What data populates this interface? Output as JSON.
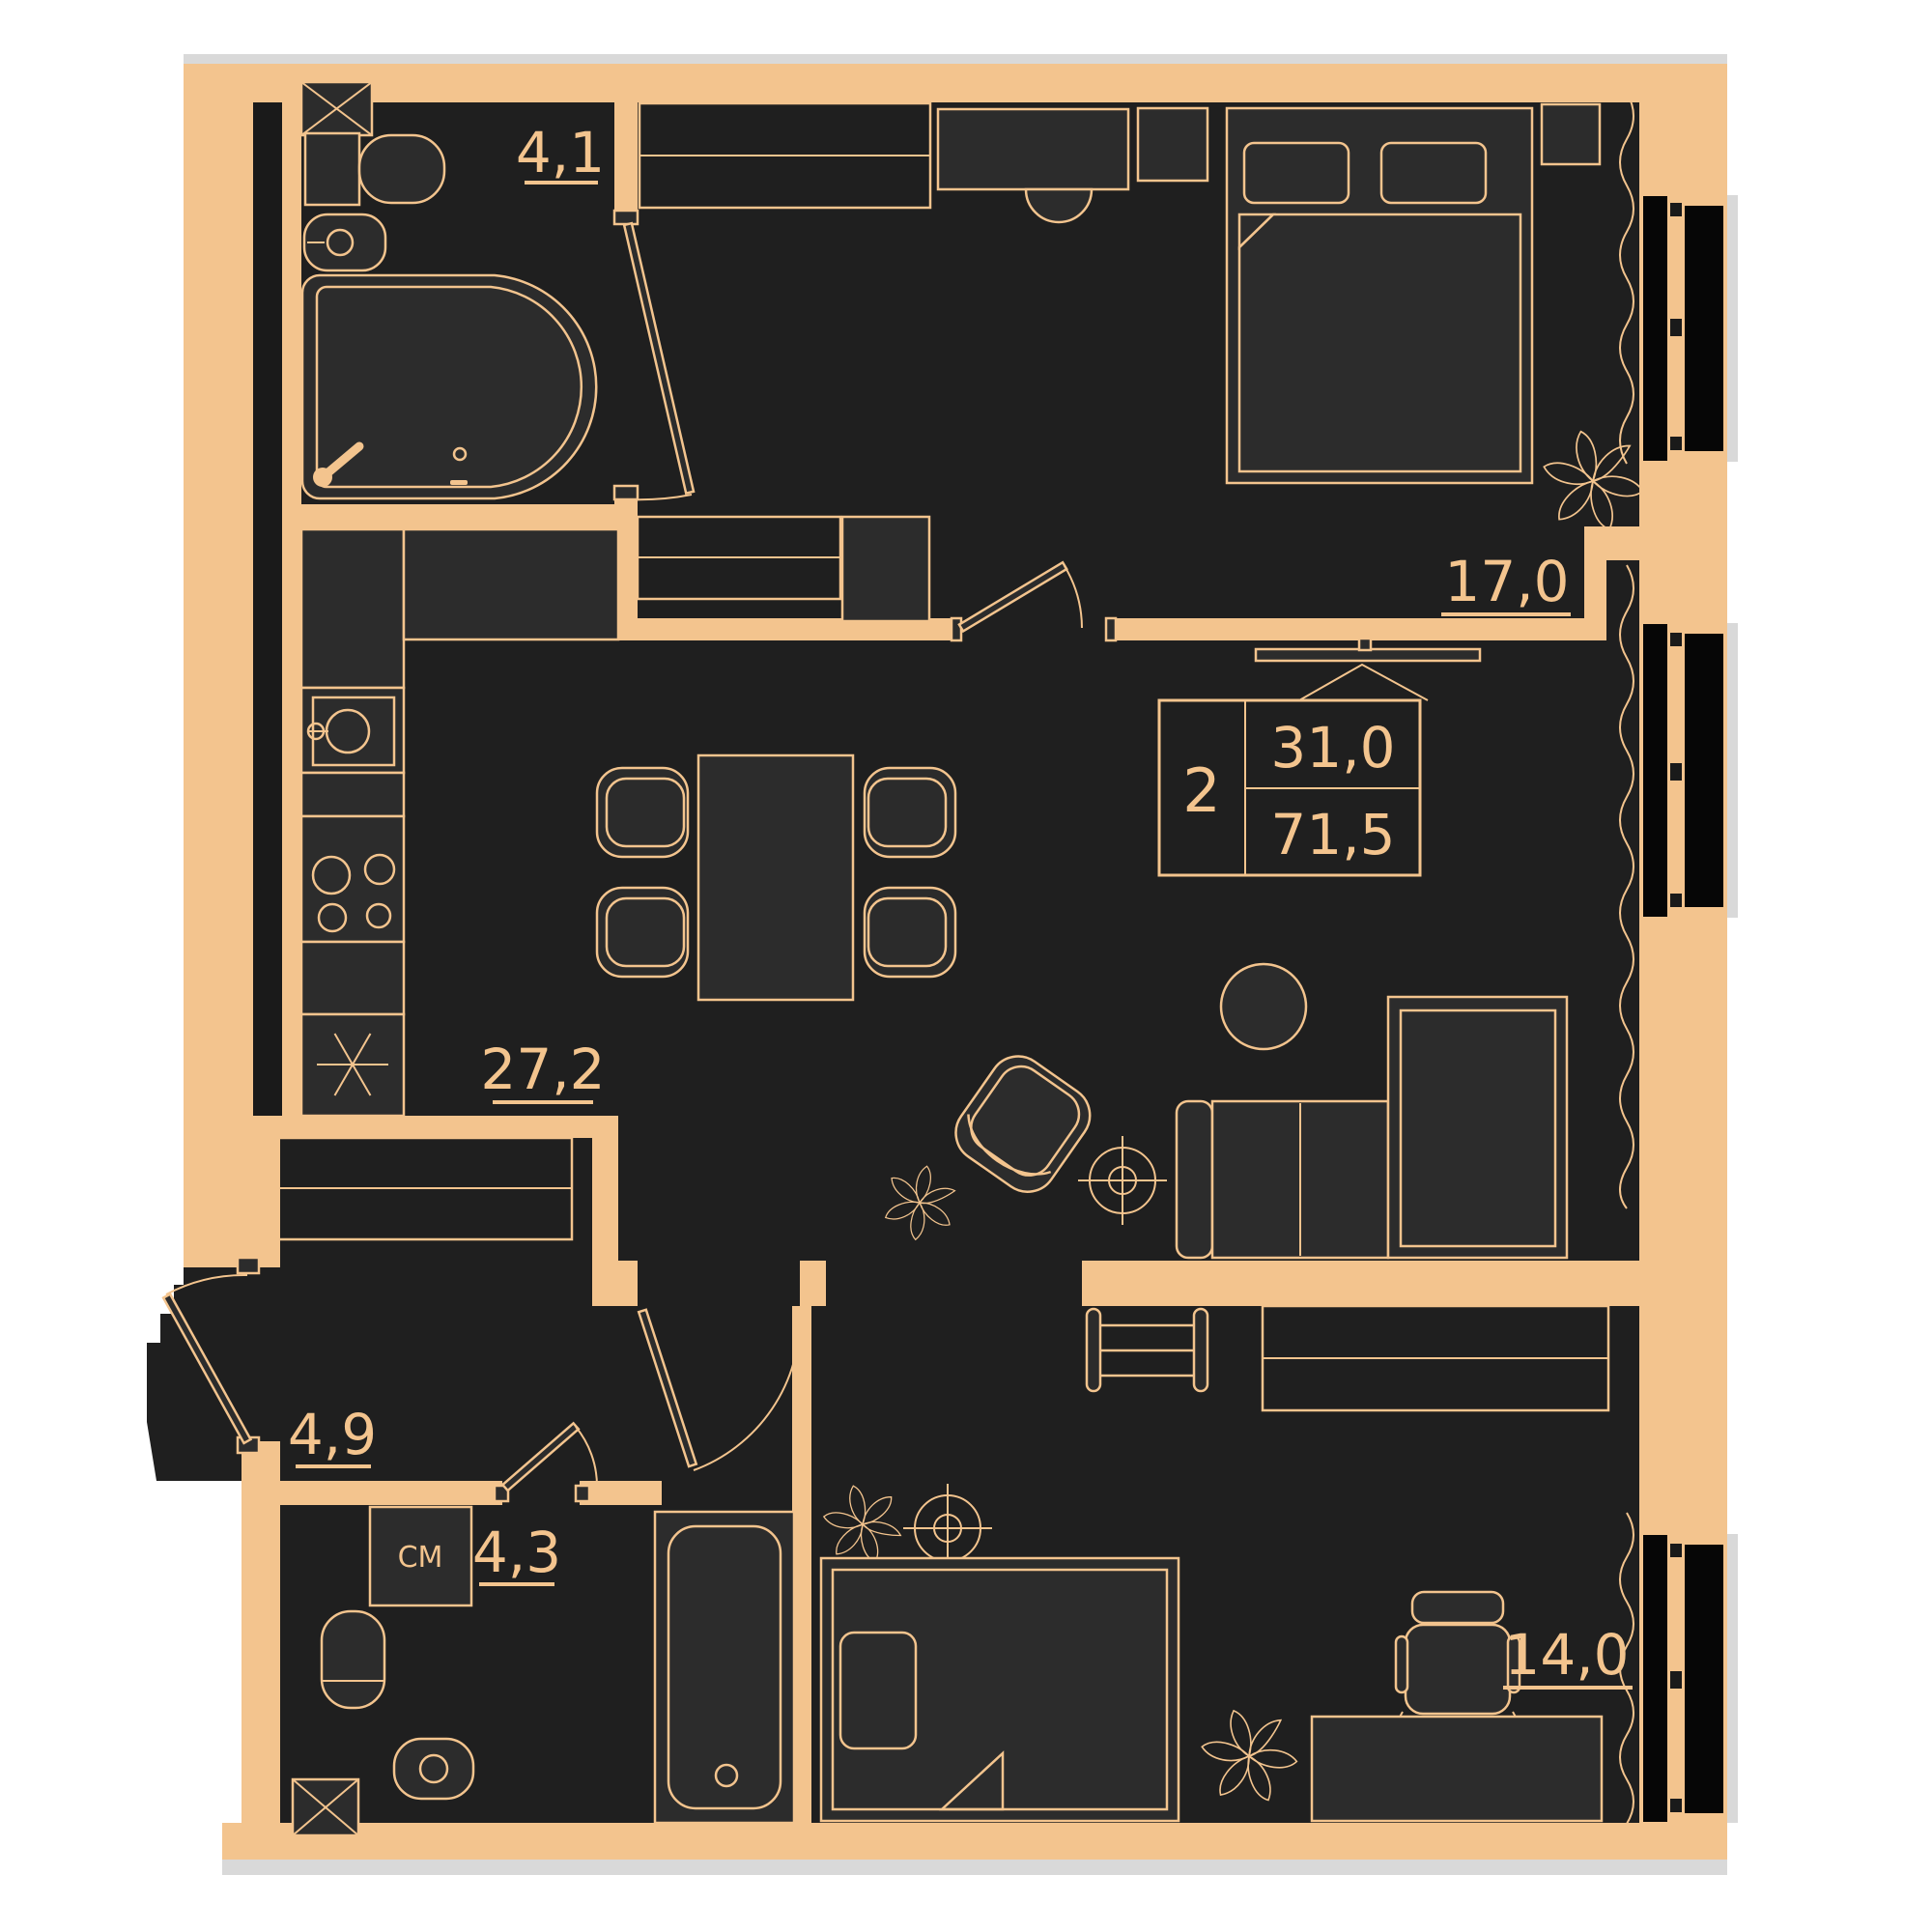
{
  "plan": {
    "type": "apartment-floor-plan",
    "labels": {
      "bathroom1": "4,1",
      "bedroom1": "17,0",
      "kitchen_living": "27,2",
      "hallway": "4,9",
      "bathroom2": "4,3",
      "bedroom2": "14,0",
      "washing_machine": "СМ"
    },
    "info_box": {
      "room_count": "2",
      "living_area": "31,0",
      "total_area": "71,5"
    },
    "colors": {
      "wall": "#f3c48e",
      "floor": "#1f1f1f",
      "furniture": "#2c2c2c",
      "window_glass": "#060606",
      "shadow": "#d9d9d9",
      "background": "#ffffff"
    },
    "icons": [
      "bathtub-icon",
      "toilet-icon",
      "washbasin-icon",
      "stove-icon",
      "kitchen-sink-icon",
      "dishwasher-icon",
      "dining-table-icon",
      "chair-icon",
      "sofa-icon",
      "coffee-table-icon",
      "armchair-icon",
      "ceiling-light-icon",
      "plant-icon",
      "bed-icon",
      "pillow-icon",
      "nightstand-icon",
      "desk-icon",
      "desk-chair-icon",
      "wardrobe-icon",
      "washing-machine-icon",
      "tv-icon",
      "curtain-icon",
      "window-icon",
      "door-icon",
      "ladder-shelf-icon",
      "shaft-icon"
    ]
  }
}
